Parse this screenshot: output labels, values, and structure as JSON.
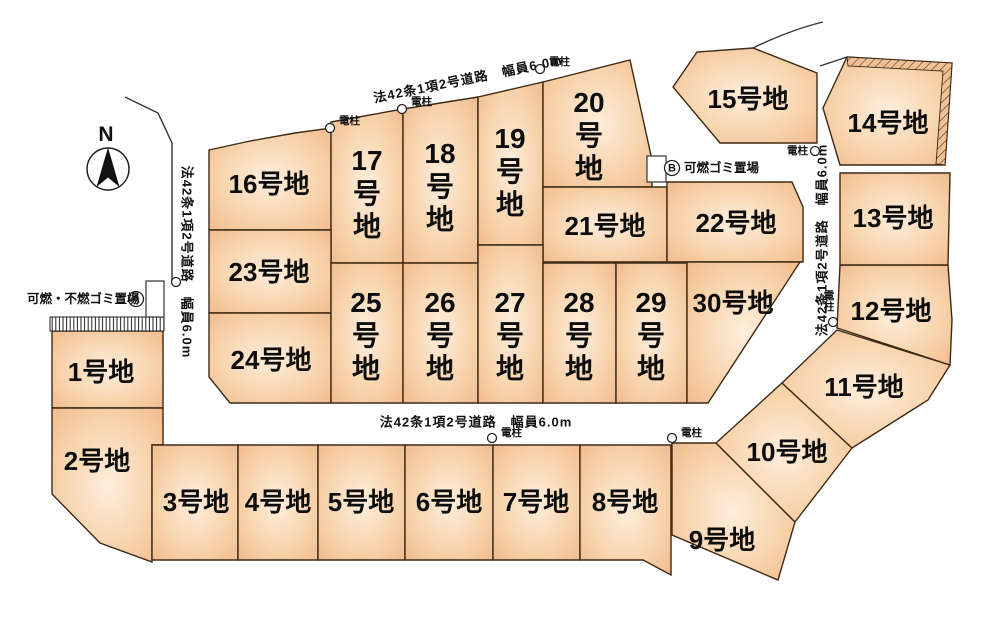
{
  "map": {
    "compass": {
      "label": "N"
    },
    "colors": {
      "plot_center": "#fdeedd",
      "plot_mid": "#f8d5ae",
      "plot_edge": "#f1ba8d",
      "plot_stroke": "#3c2a14"
    },
    "roads": [
      {
        "label": "法42条1項2号道路　幅員6.0m",
        "x": 468,
        "y": 79,
        "rotation": -11.5
      },
      {
        "label": "法42条1項2号道路　幅員6.0m",
        "x": 187,
        "y": 262,
        "rotation": 90
      },
      {
        "label": "法42条1項2号道路　幅員6.0m",
        "x": 822,
        "y": 240,
        "rotation": -90
      },
      {
        "label": "法42条1項2号道路　幅員6.0m",
        "x": 476,
        "y": 422,
        "rotation": 0
      }
    ],
    "poles": [
      {
        "x": 330,
        "y": 128,
        "label": "電柱",
        "label_x": 339,
        "label_y": 121,
        "anchor": "start"
      },
      {
        "x": 402,
        "y": 109,
        "label": "電柱",
        "label_x": 411,
        "label_y": 102,
        "anchor": "start"
      },
      {
        "x": 540,
        "y": 69,
        "label": "電柱",
        "label_x": 549,
        "label_y": 62,
        "anchor": "start"
      },
      {
        "x": 815,
        "y": 151,
        "label": "電柱",
        "label_x": 808,
        "label_y": 151,
        "anchor": "end"
      },
      {
        "x": 833,
        "y": 322,
        "label": "電柱",
        "label_x": 829,
        "label_y": 296,
        "anchor": "middle",
        "vertical": true
      },
      {
        "x": 492,
        "y": 438,
        "label": "電柱",
        "label_x": 501,
        "label_y": 433,
        "anchor": "start"
      },
      {
        "x": 672,
        "y": 438,
        "label": "電柱",
        "label_x": 681,
        "label_y": 433,
        "anchor": "start"
      },
      {
        "x": 176,
        "y": 282,
        "label": ""
      }
    ],
    "garbage_stations": [
      {
        "badge": "A",
        "label": "可燃・不燃ゴミ置場",
        "label_x": 27,
        "label_y": 299,
        "badge_x": 136,
        "badge_y": 299,
        "box": [
          146,
          281,
          18,
          36
        ],
        "strip": [
          50,
          317,
          114,
          14
        ]
      },
      {
        "badge": "B",
        "label": "可燃ゴミ置場",
        "label_x": 684,
        "label_y": 168,
        "badge_x": 672,
        "badge_y": 168,
        "box": [
          647,
          156,
          19,
          26
        ]
      }
    ],
    "plots": [
      {
        "id": 1,
        "label": "1号地",
        "orient": "h",
        "lx": 101,
        "ly": 372,
        "points": "52,331 163,331 163,408 52,408"
      },
      {
        "id": 2,
        "label": "2号地",
        "orient": "h",
        "lx": 97,
        "ly": 461,
        "points": "52,408 163,408 163,445 152,445 152,562 100,543 52,494"
      },
      {
        "id": 3,
        "label": "3号地",
        "orient": "h",
        "lx": 196,
        "ly": 502,
        "points": "152,445 238,445 238,560 152,560"
      },
      {
        "id": 4,
        "label": "4号地",
        "orient": "h",
        "lx": 278,
        "ly": 502,
        "points": "238,445 318,445 318,560 238,560"
      },
      {
        "id": 5,
        "label": "5号地",
        "orient": "h",
        "lx": 361,
        "ly": 502,
        "points": "318,445 405,445 405,560 318,560"
      },
      {
        "id": 6,
        "label": "6号地",
        "orient": "h",
        "lx": 449,
        "ly": 502,
        "points": "405,445 493,445 493,560 405,560"
      },
      {
        "id": 7,
        "label": "7号地",
        "orient": "h",
        "lx": 536,
        "ly": 502,
        "points": "493,445 580,445 580,560 493,560"
      },
      {
        "id": 8,
        "label": "8号地",
        "orient": "h",
        "lx": 625,
        "ly": 502,
        "points": "580,445 671,445 671,575 643,560 580,560"
      },
      {
        "id": 9,
        "label": "9号地",
        "orient": "h",
        "lx": 722,
        "ly": 540,
        "points": "672,443 716,443 795,522 778,580 672,535"
      },
      {
        "id": 10,
        "label": "10号地",
        "orient": "h",
        "lx": 787,
        "ly": 452,
        "points": "716,443 782,383 852,448 795,522"
      },
      {
        "id": 11,
        "label": "11号地",
        "orient": "h",
        "lx": 864,
        "ly": 387,
        "points": "782,383 837,330 950,365 928,400 852,448"
      },
      {
        "id": 12,
        "label": "12号地",
        "orient": "h",
        "lx": 891,
        "ly": 311,
        "points": "840,265 948,265 952,320 950,365 837,328"
      },
      {
        "id": 13,
        "label": "13号地",
        "orient": "h",
        "lx": 893,
        "ly": 218,
        "points": "840,173 950,173 948,265 840,265"
      },
      {
        "id": 14,
        "label": "14号地",
        "orient": "h",
        "lx": 888,
        "ly": 123,
        "points": "847,57 952,63 945,165 840,165 823,108"
      },
      {
        "id": 15,
        "label": "15号地",
        "orient": "h",
        "lx": 748,
        "ly": 99,
        "points": "673,87 697,52 753,48 817,73 817,143 720,143"
      },
      {
        "id": 16,
        "label": "16号地",
        "orient": "h",
        "lx": 269,
        "ly": 184,
        "points": "209,150 250,141 295,133 331,128 331,230 209,230"
      },
      {
        "id": 17,
        "label": "17号地",
        "orient": "v",
        "lx": 367,
        "ly": 193,
        "points": "331,122 403,109 403,263 331,263"
      },
      {
        "id": 18,
        "label": "18号地",
        "orient": "v",
        "lx": 440,
        "ly": 186,
        "points": "403,109 478,97 478,263 403,263"
      },
      {
        "id": 19,
        "label": "19号地",
        "orient": "v",
        "lx": 510,
        "ly": 171,
        "points": "478,97 543,82 543,245 478,245"
      },
      {
        "id": 20,
        "label": "20号地",
        "orient": "v",
        "lx": 589,
        "ly": 135,
        "points": "543,82 630,60 652,160 652,187 543,187"
      },
      {
        "id": 21,
        "label": "21号地",
        "orient": "h",
        "lx": 605,
        "ly": 226,
        "points": "543,187 667,187 667,262 543,262"
      },
      {
        "id": 22,
        "label": "22号地",
        "orient": "h",
        "lx": 736,
        "ly": 223,
        "points": "667,182 792,182 803,207 803,262 667,262"
      },
      {
        "id": 23,
        "label": "23号地",
        "orient": "h",
        "lx": 269,
        "ly": 272,
        "points": "209,230 331,230 331,313 209,313"
      },
      {
        "id": 24,
        "label": "24号地",
        "orient": "h",
        "lx": 271,
        "ly": 360,
        "points": "209,313 331,313 331,403 230,403 209,377"
      },
      {
        "id": 25,
        "label": "25号地",
        "orient": "v",
        "lx": 366,
        "ly": 335,
        "points": "331,263 403,263 403,403 331,403"
      },
      {
        "id": 26,
        "label": "26号地",
        "orient": "v",
        "lx": 440,
        "ly": 335,
        "points": "403,263 478,263 478,403 403,403"
      },
      {
        "id": 27,
        "label": "27号地",
        "orient": "v",
        "lx": 510,
        "ly": 335,
        "points": "478,245 543,245 543,403 478,403"
      },
      {
        "id": 28,
        "label": "28号地",
        "orient": "v",
        "lx": 579,
        "ly": 335,
        "points": "543,263 616,263 616,403 543,403"
      },
      {
        "id": 29,
        "label": "29号地",
        "orient": "v",
        "lx": 651,
        "ly": 335,
        "points": "616,263 687,263 687,403 616,403"
      },
      {
        "id": 30,
        "label": "30号地",
        "orient": "h",
        "lx": 733,
        "ly": 303,
        "points": "687,262 800,262 708,403 687,403"
      }
    ]
  }
}
